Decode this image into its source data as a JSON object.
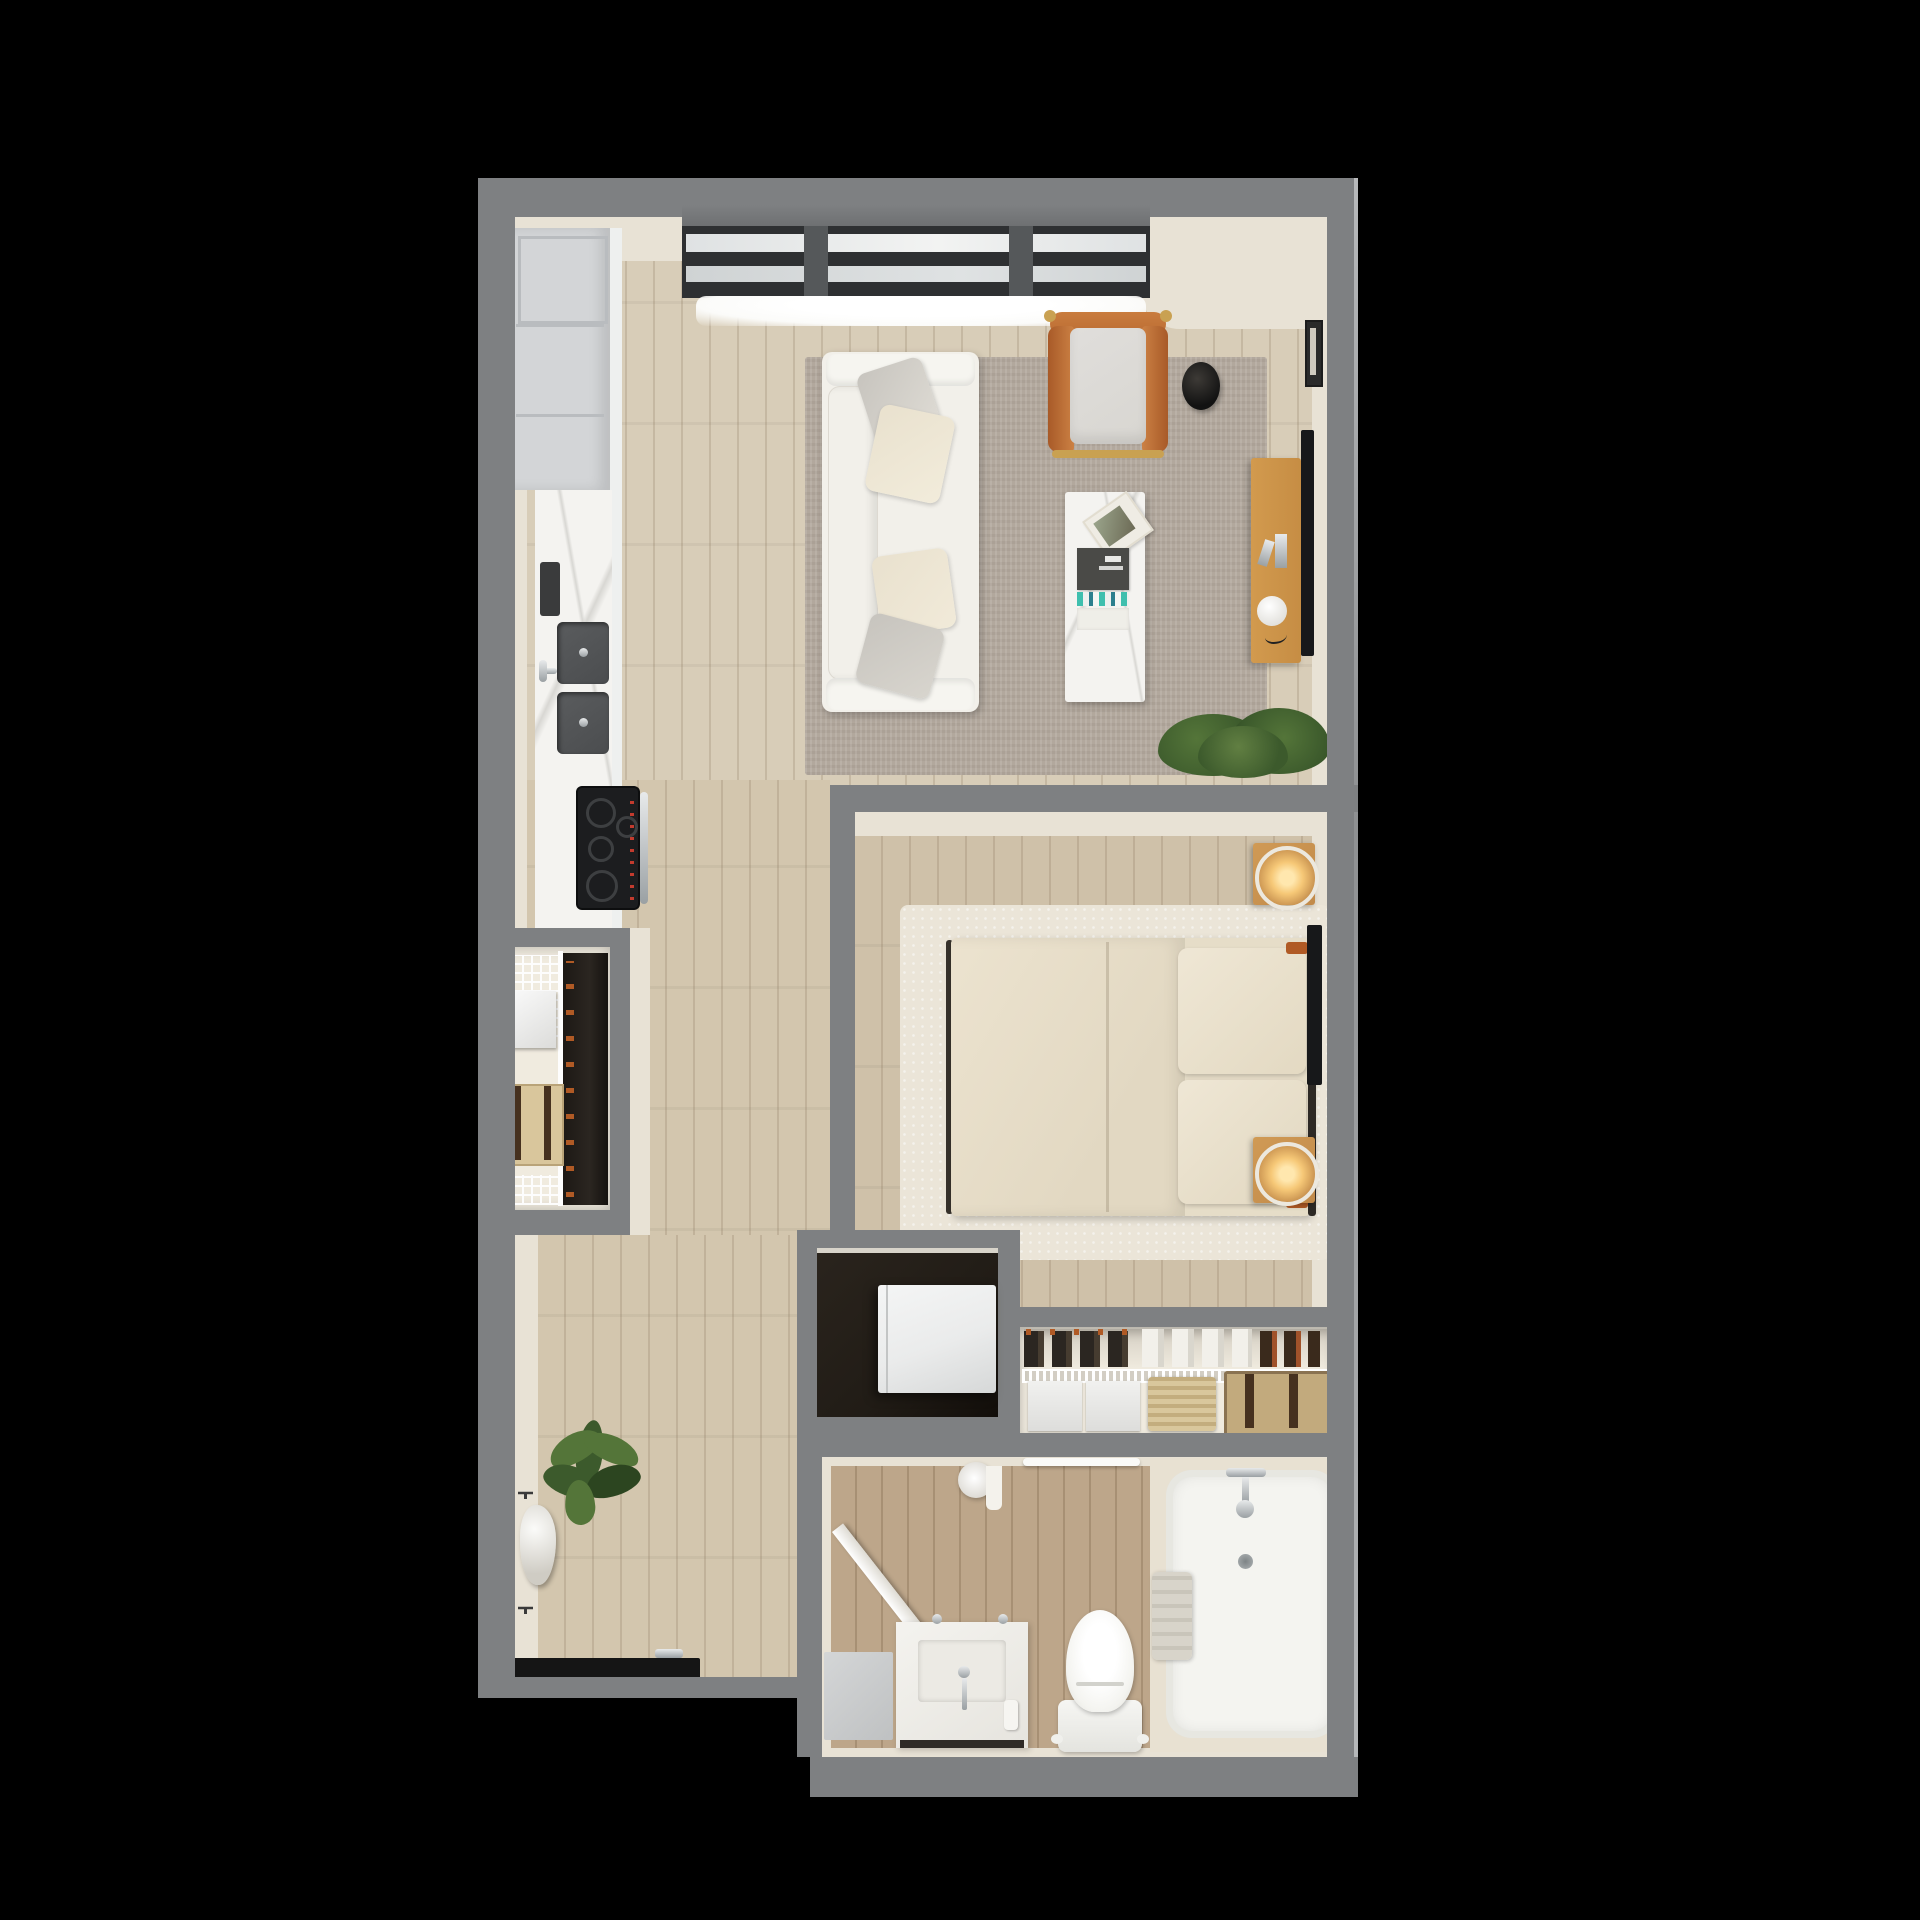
{
  "scene": {
    "title": "studio-apartment-3d-floor-plan",
    "style": "top-down architectural render on black background",
    "rooms": [
      {
        "id": "living",
        "label": "Living Room"
      },
      {
        "id": "kitchen",
        "label": "Kitchen"
      },
      {
        "id": "bedroom",
        "label": "Bedroom"
      },
      {
        "id": "bathroom",
        "label": "Bathroom"
      },
      {
        "id": "entry",
        "label": "Entry"
      },
      {
        "id": "hallway",
        "label": "Hallway"
      },
      {
        "id": "coat_closet",
        "label": "Coat Closet"
      },
      {
        "id": "laundry_closet",
        "label": "Laundry Closet"
      },
      {
        "id": "bedroom_closet",
        "label": "Bedroom Closet"
      }
    ],
    "furniture": {
      "living": [
        "sofa with four pillows",
        "leather sling accent chair",
        "round black side table",
        "white marble coffee table with books",
        "wood media console with sphere lamp",
        "wall mounted tv",
        "picture frame",
        "area rug",
        "potted shrub"
      ],
      "kitchen": [
        "tall cabinets",
        "marble countertop",
        "double basin sink",
        "four burner cooktop range",
        "small appliance"
      ],
      "bedroom": [
        "queen bed with duvet and two pillows",
        "two wood nightstands with lit lamps",
        "wall mounted tv",
        "plush area rug"
      ],
      "bathroom": [
        "bathtub with fixtures",
        "toilet",
        "vanity with sink",
        "storage cabinet",
        "towel bar",
        "toilet paper roll",
        "swinging door"
      ],
      "entry": [
        "potted plant",
        "wall hooks with hanging bag",
        "entry door"
      ],
      "coat_closet": [
        "wire shelving",
        "storage box",
        "suitcase",
        "hanging clothes"
      ],
      "laundry_closet": [
        "stacked washer dryer"
      ],
      "bedroom_closet": [
        "hanging clothes",
        "wire shelf rail",
        "drawer units",
        "woven basket",
        "travel trunk"
      ]
    },
    "window_sections": 3
  },
  "colors": {
    "bg": "#000000",
    "wall": "#7e8082",
    "wallHi": "#b7b9bb",
    "cream": "#e8e2d5",
    "creamLight": "#f0ebdf",
    "floorLiving": "#d8cdb8",
    "floorBed": "#cfc1a9",
    "floorHall": "#d3c6ae",
    "floorBath": "#bda68a",
    "plankLine": "rgba(122,100,72,0.20)",
    "rugLiving": "#b2a89d",
    "rugBed": "#ebe5d8",
    "sofa": "#f2f0ea",
    "pillowGray": "#c7c4be",
    "pillowCream": "#e9e1ce",
    "chairLeather": "#bb6c33",
    "chairCushion": "#d8d6d1",
    "gold": "#c9a152",
    "marble": "#f4f3f0",
    "vein": "#d8d7d3",
    "consoleWood": "#c68d44",
    "nsWood": "#c18a4a",
    "tvBlack": "#17181a",
    "cabinet": "#d3d5d7",
    "cabinetLine": "#b9bcbf",
    "sinkDark": "#4b4d4f",
    "stoveBlack": "#1c1d1f",
    "glassPane": "#dfe2e3",
    "frameDark": "#2e3032",
    "sillGlow": "#fbfbf9",
    "closetDark": "#211c16",
    "clothesDark": "#2b2621",
    "hanger": "#b05a25",
    "suitcaseTan": "#d9c69c",
    "strapBrown": "#46311f",
    "trunkTan": "#c2aa7d",
    "washerWhite": "#eaebeb",
    "bedLinen": "#e6ddc8",
    "duvet": "#ece3cf",
    "lampGlow": "#f6c877",
    "tubDeck": "#e8e1d2",
    "fixture": "#b9bcbe",
    "porcelain": "#f4f4f0",
    "towel": "#d8d4ca",
    "doorBlack": "#151515",
    "green1": "#3c5a2c",
    "green2": "#547539",
    "green3": "#2c4520"
  }
}
